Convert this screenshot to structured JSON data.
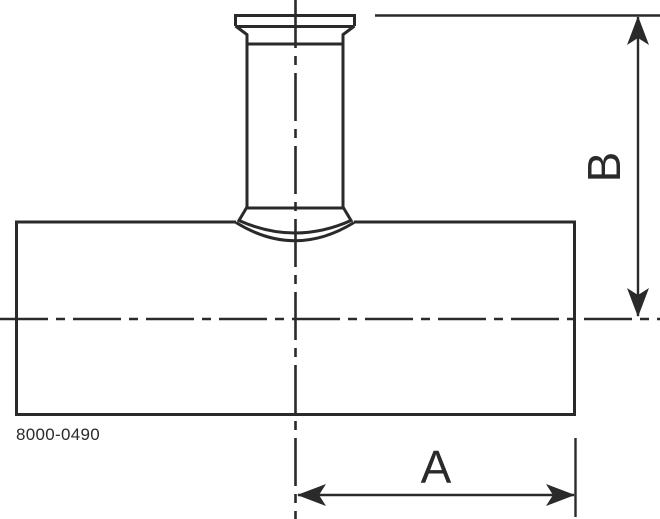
{
  "drawing": {
    "part_number": "8000-0490",
    "labels": {
      "dim_a": "A",
      "dim_b": "B"
    },
    "colors": {
      "line": "#2b2a29",
      "background": "#ffffff"
    }
  }
}
